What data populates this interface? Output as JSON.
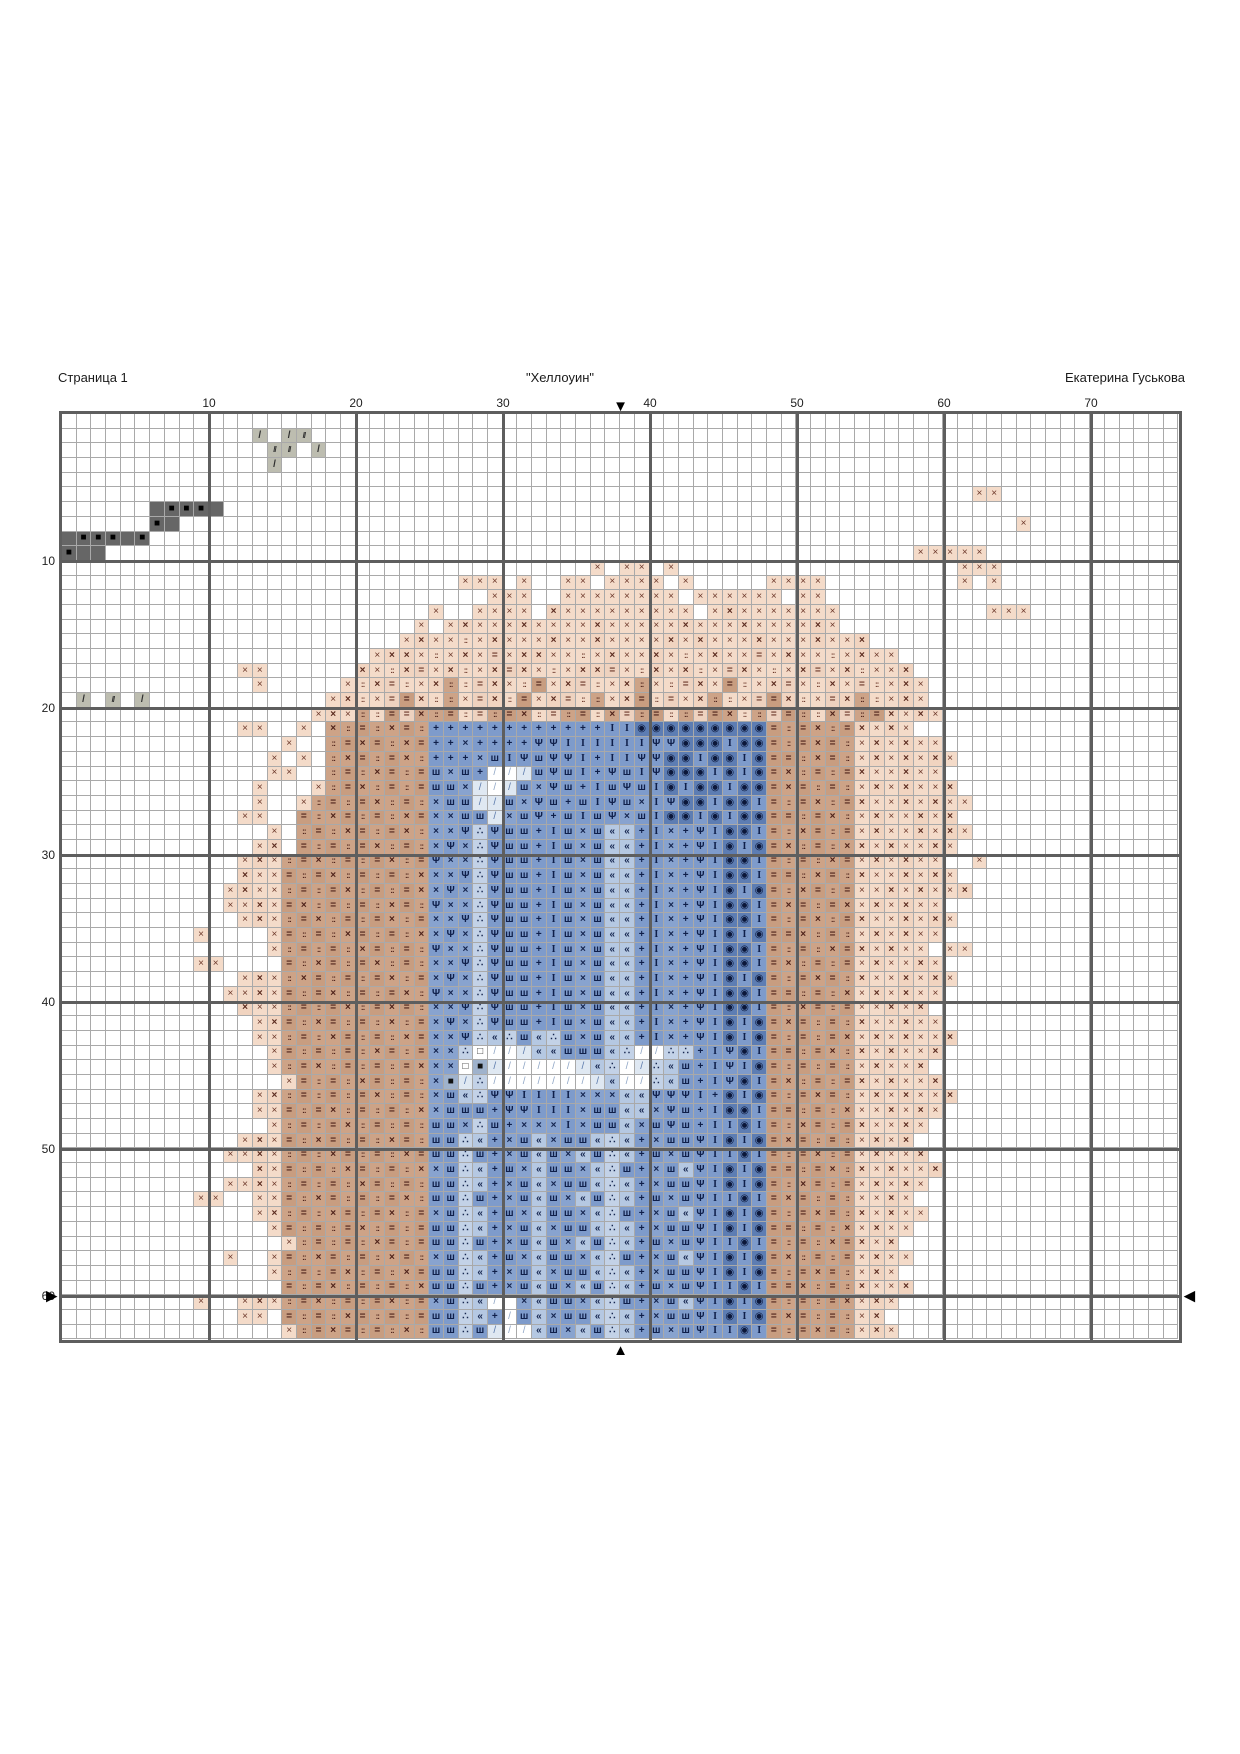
{
  "header": {
    "page_label": "Страница 1",
    "title": "\"Хеллоуин\"",
    "author": "Екатерина Гуськова"
  },
  "grid": {
    "cols": 76,
    "rows": 63,
    "cell_px": 14.7,
    "col_labels": [
      10,
      20,
      30,
      40,
      50,
      60,
      70
    ],
    "row_labels": [
      10,
      20,
      30,
      40,
      50,
      60
    ],
    "thick_every": 10,
    "thin_line_color": "#a9a9a9",
    "thick_line_color": "#5e5e5e"
  },
  "markers": {
    "top_glyph": "▼",
    "bottom_glyph": "▲",
    "left_glyph": "▶",
    "right_glyph": "◀",
    "center_col": 38,
    "side_row": 60
  },
  "palette": {
    "a": {
      "bg": "#f4dbc9",
      "sym": "×",
      "fg": "#6d392b",
      "bold": false
    },
    "b": {
      "bg": "#f1d4c0",
      "sym": "×",
      "fg": "#5a2a1e",
      "bold": true
    },
    "c": {
      "bg": "#f4dbc9",
      "sym": "::",
      "fg": "#6d392b",
      "bold": true,
      "small": true
    },
    "d": {
      "bg": "#eed2bf",
      "sym": "=",
      "fg": "#6d392b",
      "bold": true
    },
    "e": {
      "bg": "#cda387",
      "sym": "×",
      "fg": "#4e221a",
      "bold": true
    },
    "f": {
      "bg": "#cda387",
      "sym": "::",
      "fg": "#4e221a",
      "bold": true,
      "small": true
    },
    "g": {
      "bg": "#c89d80",
      "sym": "=",
      "fg": "#4e221a",
      "bold": true
    },
    "h": {
      "bg": "#7e9bcb",
      "sym": "+",
      "fg": "#0f1f4a",
      "bold": true
    },
    "i": {
      "bg": "#7e9bcb",
      "sym": "I",
      "fg": "#0f1f4a",
      "bold": true,
      "serif": true
    },
    "j": {
      "bg": "#7e9bcb",
      "sym": "Ψ",
      "fg": "#0f1f4a",
      "bold": true
    },
    "k": {
      "bg": "#88a3cf",
      "sym": "×",
      "fg": "#14244e",
      "bold": true
    },
    "l": {
      "bg": "#7e9bcb",
      "sym": "ш",
      "fg": "#0f1f4a",
      "bold": true
    },
    "m": {
      "bg": "#b5c8e2",
      "sym": "«",
      "fg": "#16264f",
      "bold": true
    },
    "n": {
      "bg": "#c3d2e7",
      "sym": "∴",
      "fg": "#16264f",
      "bold": true
    },
    "o": {
      "bg": "#5d7db3",
      "sym": "◉",
      "fg": "#0b173a",
      "bold": false
    },
    "q": {
      "bg": "#dfe8f2",
      "sym": "/",
      "fg": "#5a79ab",
      "bold": false
    },
    "r": {
      "bg": "#ffffff",
      "sym": "/",
      "fg": "#8fa6c6",
      "bold": false
    },
    "s": {
      "bg": "#bdbdb0",
      "sym": "//",
      "fg": "#2e2e2e",
      "bold": true,
      "small": true
    },
    "t": {
      "bg": "#bdbdb0",
      "sym": "/",
      "fg": "#2e2e2e",
      "bold": true
    },
    "u": {
      "bg": "#666666",
      "sym": "■",
      "fg": "#000000",
      "bold": false
    },
    "v": {
      "bg": "#666666",
      "sym": "",
      "fg": "#000000",
      "bold": false
    },
    "w": {
      "bg": "#ffffff",
      "sym": "□",
      "fg": "#333333",
      "bold": false
    },
    "x": {
      "bg": "#9fb2cc",
      "sym": "■",
      "fg": "#111111",
      "bold": false
    },
    ".": {
      "bg": "#ffffff",
      "sym": "",
      "fg": "#000000",
      "bold": false
    }
  },
  "pattern": [
    [
      [
        76,
        "."
      ]
    ],
    [
      [
        13,
        "."
      ],
      "t.ts",
      [
        59,
        "."
      ]
    ],
    [
      [
        14,
        "."
      ],
      "ss.t",
      [
        58,
        "."
      ]
    ],
    [
      [
        14,
        "."
      ],
      "t",
      [
        61,
        "."
      ]
    ],
    [
      [
        76,
        "."
      ]
    ],
    [
      [
        62,
        "."
      ],
      "aa",
      [
        12,
        "."
      ]
    ],
    [
      [
        6,
        "."
      ],
      "vuuuv",
      [
        65,
        "."
      ]
    ],
    [
      [
        6,
        "."
      ],
      "uv",
      [
        57,
        "."
      ],
      "a",
      [
        10,
        "."
      ]
    ],
    [
      "vuuuvu",
      [
        70,
        "."
      ]
    ],
    [
      "uvv",
      [
        55,
        "."
      ],
      "aaaaa",
      [
        13,
        "."
      ]
    ],
    [
      [
        36,
        "."
      ],
      "a.aa.a",
      [
        19,
        "."
      ],
      "aaa",
      [
        12,
        "."
      ]
    ],
    [
      [
        27,
        "."
      ],
      "aaa.a..aa.aaaa.a",
      [
        5,
        "."
      ],
      "aaaa",
      [
        9,
        "."
      ],
      "a.a",
      [
        12,
        "."
      ]
    ],
    [
      [
        29,
        "."
      ],
      "aaa..aaaaaaaa.aaaaaa.aa",
      [
        24,
        "."
      ]
    ],
    [
      [
        25,
        "."
      ],
      "a..aaaa.baaaaaaaaa.abaaaaaaa",
      [
        10,
        "."
      ],
      "aaa",
      [
        10,
        "."
      ]
    ],
    [
      [
        24,
        "."
      ],
      "a.",
      "abaaabaaaabaaaaabaaabaaaaba",
      [
        23,
        "."
      ]
    ],
    [
      [
        23,
        "."
      ],
      "abaacabaaabaabaaaababaaabaaabaab",
      [
        21,
        "."
      ]
    ],
    [
      [
        21,
        "."
      ],
      "abbacabadabbaacabaabacabaadabaacabaa",
      [
        19,
        "."
      ]
    ],
    [
      [
        12,
        "."
      ],
      "aa",
      [
        6,
        "."
      ],
      "bacbdabcabdbacabbdacbabcadbacabdabcaab",
      [
        18,
        "."
      ]
    ],
    [
      [
        13,
        "."
      ],
      "a",
      [
        5,
        "."
      ],
      "acbdcabfcdbacgabdcabfacdbagcabdacbadcaba",
      [
        17,
        "."
      ]
    ],
    [
      ".t.s.t",
      [
        12,
        "."
      ],
      "abcadgbcfadbcgabdcfabgcdabfcadgbcadbfcaba",
      [
        17,
        "."
      ]
    ],
    [
      [
        17,
        "."
      ],
      "abafcgdefgcdfgecdfgcedfgcfdgecfdgfcedfgbaba",
      [
        16,
        "."
      ]
    ],
    [
      [
        12,
        "."
      ],
      "aa..a.",
      "efgfegf",
      "hhhhhhhhhhhh",
      "ii",
      "ooooooooo",
      "g",
      "fgefg",
      "baba",
      [
        18,
        "."
      ]
    ],
    [
      [
        15,
        "."
      ],
      "a..",
      "fgegfeg",
      "hhkhhhhjjiiiiiijjoooioo",
      "g",
      "fgegf",
      "ababaa",
      [
        16,
        "."
      ]
    ],
    [
      [
        14,
        "."
      ],
      "a.a.",
      "fegfgef",
      "hhhklijljjihiijjooiooio",
      "g",
      "gfegf",
      "abababa",
      [
        15,
        "."
      ]
    ],
    [
      [
        14,
        "."
      ],
      "aa..",
      "fgfegfg",
      "lklhrrqljlihjlijoooioio",
      "g",
      "efgfg",
      "baabaa",
      [
        16,
        "."
      ]
    ],
    [
      [
        13,
        "."
      ],
      "a...",
      "afgefgfg",
      "llkqrqlkjlhiljlioiooioo",
      "g",
      "egfgf",
      "ababaab",
      [
        15,
        "."
      ]
    ],
    [
      [
        13,
        "."
      ],
      "a..a",
      "fgfgefgf",
      "kllqqlkjlhlijlkijooiooi",
      "g",
      "fgefg",
      "baababaa",
      [
        14,
        "."
      ]
    ],
    [
      [
        12,
        "."
      ],
      "aa..",
      "gfegfgfeg",
      "kkllqkljhliljkliooioioo",
      "g",
      "gfgef",
      "abaabab",
      [
        15,
        "."
      ]
    ],
    [
      [
        14,
        "."
      ],
      "a.",
      "fgfegfgef",
      "kkjnjllhilklmmhikhjiooi",
      "g",
      "fegfg",
      "abaababa",
      [
        13,
        "."
      ]
    ],
    [
      [
        13,
        "."
      ],
      "ab.",
      "gfgfgefgf",
      "kjknjllhilklmmhikhjioio",
      "g",
      "efgfe",
      "babaaba",
      [
        15,
        "."
      ]
    ],
    [
      [
        12,
        "."
      ],
      "aba",
      "fgefgfgefg",
      "jkknjllhilklmmhikhjiooi",
      "g",
      "fgfeg",
      "ababaa..a",
      [
        13,
        "."
      ]
    ],
    [
      [
        12,
        "."
      ],
      "baa",
      "gfgefgfgfe",
      "kkjnjllhilklmmhikhjiooi",
      "g",
      "gfegf",
      "baababa",
      [
        15,
        "."
      ]
    ],
    [
      [
        11,
        "."
      ],
      "abaa",
      "fgfgefgfge",
      "kjknjllhilklmmhikhjioio",
      "g",
      "fegfg",
      "aababaab",
      [
        14,
        "."
      ]
    ],
    [
      [
        11,
        "."
      ],
      "aaba",
      "gefgfgfegf",
      "jkknjllhilklmmhikhjiooi",
      "g",
      "egfge",
      "ababaa",
      [
        16,
        "."
      ]
    ],
    [
      [
        12,
        "."
      ],
      "aba",
      "fgefgfgefg",
      "kkjnjllhilklmmhikhjiooi",
      "g",
      "fgefg",
      "baababa",
      [
        15,
        "."
      ]
    ],
    [
      [
        9,
        "."
      ],
      "a",
      [
        4,
        "."
      ],
      "a",
      "gfgfegfgfe",
      "kjknjllhilklmmhikhjioio",
      "g",
      "gefgf",
      "ababaa",
      [
        16,
        "."
      ]
    ],
    [
      [
        14,
        "."
      ],
      "a",
      "fgfgfegfgf",
      "jkknjllhilklmmhikhjiooi",
      "g",
      "fgfeg",
      "babaa.aa",
      [
        14,
        "."
      ]
    ],
    [
      [
        9,
        "."
      ],
      "aa",
      [
        4,
        "."
      ],
      "gfegfgefgf",
      "kkjnjllhilklmmhikhjiooi",
      "g",
      "efgfg",
      "abaaba",
      [
        16,
        "."
      ]
    ],
    [
      [
        12,
        "."
      ],
      "aba",
      "fegfgfgefg",
      "kjknjllhilklmmhikhjioio",
      "g",
      "fgegf",
      "baababa",
      [
        15,
        "."
      ]
    ],
    [
      [
        11,
        "."
      ],
      "aaba",
      "gfgefgfgef",
      "jkknjllhilklmmhikhjiooi",
      "g",
      "gfgfe",
      "ababaa",
      [
        16,
        "."
      ]
    ],
    [
      [
        12,
        "."
      ],
      "baa",
      "fgfgefgegf",
      "kkjnjllhilklmmhikhjiooi",
      "g",
      "fegfg",
      "aabab",
      [
        17,
        "."
      ]
    ],
    [
      [
        13,
        "."
      ],
      "ab",
      "gfegfgfefg",
      "kjknjllhilklmmhikhjioio",
      "g",
      "egfgf",
      "baabaa",
      [
        16,
        "."
      ]
    ],
    [
      [
        13,
        "."
      ],
      "aa",
      "fgfegfgfeg",
      "kkjnmnlmnlklmmhikhjioio",
      "g",
      "fgfge",
      "ababaab",
      [
        15,
        "."
      ]
    ],
    [
      [
        14,
        "."
      ],
      "a",
      "gfgfgfegfg",
      "kknwrrqmmlllmnrrnnhijoi",
      "g",
      "gfgef",
      "babaab",
      [
        16,
        "."
      ]
    ],
    [
      [
        14,
        "."
      ],
      "a",
      "fgefgfgfge",
      "kkwxqrrrrrqmnrqnmlhijio",
      "g",
      "fgfgf",
      "abaab",
      [
        17,
        "."
      ]
    ],
    [
      [
        15,
        "."
      ],
      "a",
      "gfgfegfgf",
      "kxqnrrrrrrrqmrrnmlhijoi",
      "g",
      "efgfg",
      "babaab",
      [
        16,
        "."
      ]
    ],
    [
      [
        13,
        "."
      ],
      "ab",
      "fgfgfgefgf",
      "klmnjjiiiikkkmmjjjihoio",
      "g",
      "fgegf",
      "ababaab",
      [
        15,
        "."
      ]
    ],
    [
      [
        13,
        "."
      ],
      "aa",
      "gfgefgfgfe",
      "klllhjjiiikllmmkjlhiooi",
      "g",
      "gfgfe",
      "aababa",
      [
        16,
        "."
      ]
    ],
    [
      [
        14,
        "."
      ],
      "a",
      "fgfgefgfgf",
      "llknlhkkkikllmkljlhiioi",
      "g",
      "fegfg",
      "baaba",
      [
        17,
        "."
      ]
    ],
    [
      [
        12,
        "."
      ],
      "aba",
      "gfegfgfegf",
      "llnmhklmkllmnmhklljioio",
      "g",
      "egfgf",
      "abab",
      [
        18,
        "."
      ]
    ],
    [
      [
        11,
        "."
      ],
      "aaba",
      "fgfegfgfeg",
      "llnlhklmlkmlnmhlkljiioi",
      "g",
      "fgefg",
      "abaab",
      [
        17,
        "."
      ]
    ],
    [
      [
        13,
        "."
      ],
      "ba",
      "gfgfegfgfe",
      "klnmhlkmllkmnlhklmjioio",
      "g",
      "gfgef",
      "babaab",
      [
        16,
        "."
      ]
    ],
    [
      [
        11,
        "."
      ],
      "aaba",
      "fgfgfegfgf",
      "llnmhklmkllmnmhklljioio",
      "g",
      "fegfg",
      "ababa",
      [
        17,
        "."
      ]
    ],
    [
      [
        9,
        "."
      ],
      "aa",
      [
        2,
        "."
      ],
      "aa",
      "gfegfgfgef",
      "llnlhklmlkmlnmhlkljiioi",
      "g",
      "egfgf",
      "aaba",
      [
        18,
        "."
      ]
    ],
    [
      [
        13,
        "."
      ],
      "ab",
      "fgfegfgefg",
      "klnmhlkmllkmnlhklmjioio",
      "g",
      "fgegf",
      "babaa",
      [
        17,
        "."
      ]
    ],
    [
      [
        14,
        "."
      ],
      "a",
      "gfgfgefgfg",
      "llnmhklmkllmnmhklljioio",
      "g",
      "gfgfe",
      "abaa",
      [
        18,
        "."
      ]
    ],
    [
      [
        15,
        "."
      ],
      "afgfgfegfg",
      "llnlhklmlkmlnmhlkljiioi",
      "g",
      "fgfeg",
      "bab",
      [
        19,
        "."
      ]
    ],
    [
      [
        11,
        "."
      ],
      "a",
      [
        2,
        "."
      ],
      "a",
      "gfegfgfegf",
      "klnmhlkmllkmnlhklmjioio",
      "g",
      "efgfg",
      "abaa",
      [
        18,
        "."
      ]
    ],
    [
      [
        14,
        "."
      ],
      "a",
      "fgfgefgfeg",
      "llnmhklmkllmnmhklljioio",
      "g",
      "fgegf",
      "aba",
      [
        19,
        "."
      ]
    ],
    [
      [
        15,
        "."
      ],
      "gfgefgfgfe",
      "llnlhklmlkmlnmhlkljiioi",
      "g",
      "gefgf",
      "baab",
      [
        18,
        "."
      ]
    ],
    [
      [
        9,
        "."
      ],
      "a",
      [
        2,
        "."
      ],
      "aba",
      "fgefgfgefg",
      "klnmr.kmllkmnlhklmjioio",
      "g",
      "fgfge",
      "aba",
      [
        19,
        "."
      ]
    ],
    [
      [
        12,
        "."
      ],
      "aa.",
      "gfgfegfgfg",
      "llnmhrlmkllmnmhklljioio",
      "g",
      "egfgf",
      "ab",
      [
        20,
        "."
      ]
    ],
    [
      [
        15,
        "."
      ],
      "afgegfgfef",
      "llnlqrrmlkmlnmhlkljiioi",
      "g",
      "fgegf",
      "aba",
      [
        19,
        "."
      ]
    ]
  ]
}
